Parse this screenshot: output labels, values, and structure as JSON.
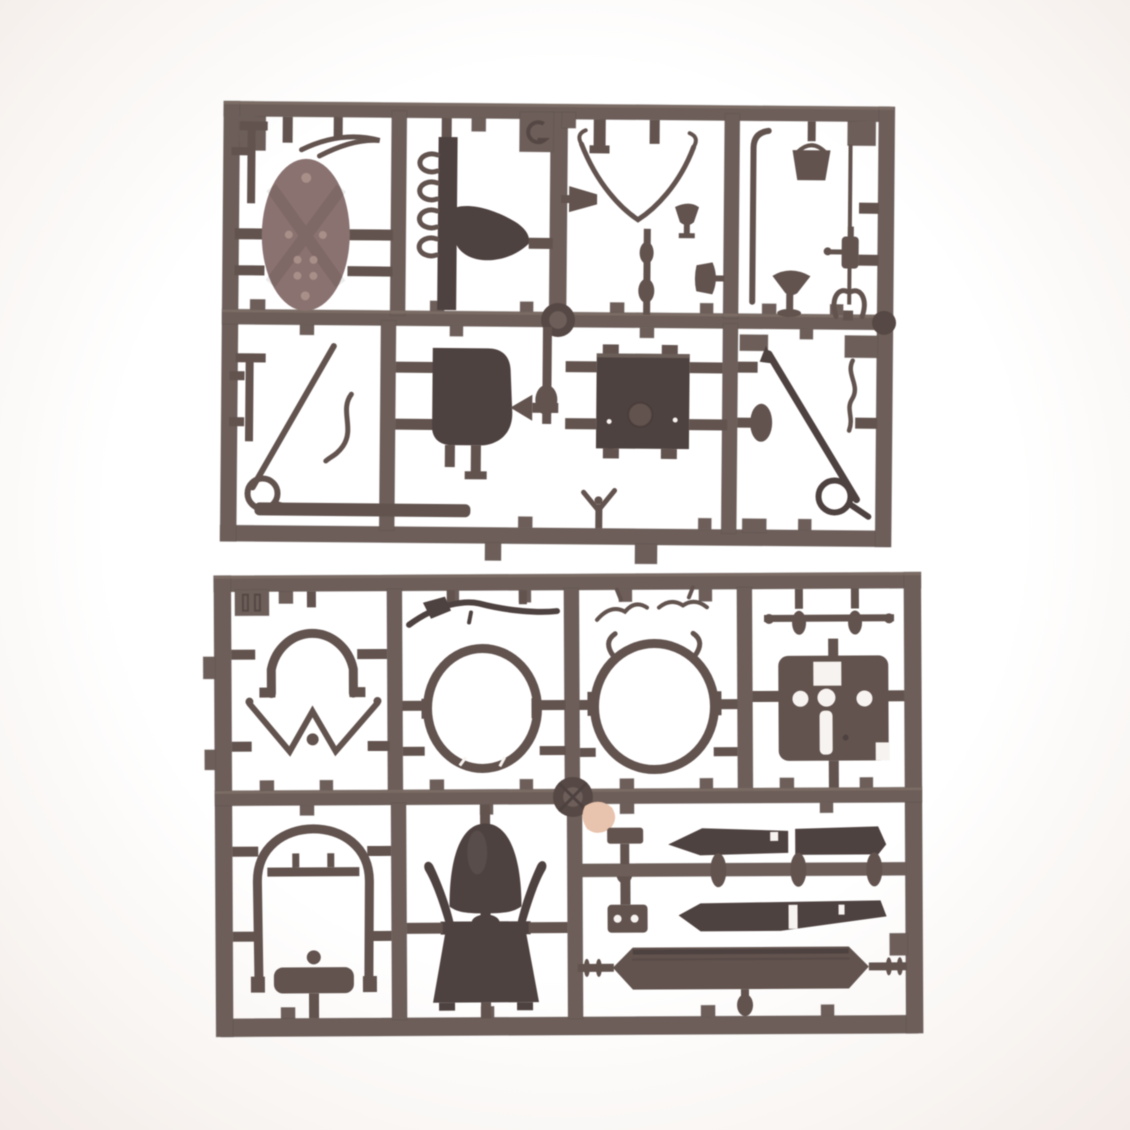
{
  "scene": {
    "type": "photograph",
    "subject": "Two dark grey-brown injection-moulded plastic model-kit sprues (part frames) lying on a plain white background",
    "layout": "upper sprue occupies the top half, lower sprue the bottom half; both are horizontal rectangular frames full of runners and attached parts",
    "sprues": [
      {
        "id": "upper-sprue",
        "structure": "rectangular outer frame, one horizontal mid runner, vertical runners forming 4 upper cells and 3 lower cells, round junction disc at centre",
        "notable_parts": [
          "oval riveted shield plate (lighter red-brown)",
          "curved seat back with four side hooks",
          "wishbone / lyre shaped yoke",
          "trumpet and goblet fittings",
          "turned baluster rod",
          "walking-stick bent rod",
          "small bucket with handle",
          "thin rod with bottle-shaped fitting",
          "bell funnel on stem",
          "pair of curled horns",
          "T-headed rod",
          "long diagonal rod ending in a ring",
          "S-curved hook",
          "flat floor plank",
          "solid bucket seat",
          "strong-box with round knob and two screw dots",
          "plunger with mushroom cap",
          "tiny figure with raised arms",
          "long diagonal spear ending in a ring",
          "wavy bracket strip",
          "embossed moulding tab on the top rail"
        ]
      },
      {
        "id": "lower-sprue",
        "structure": "rectangular outer frame, horizontal mid runner with round junction wheel, vertical runners forming 4 upper cells and 3 lower cells",
        "notable_parts": [
          "embossed moulding tab at top-left",
          "horseshoe arch with flared feet",
          "double-wishbone axle with centre ball",
          "musket-like curved stick",
          "large open oval hoop (left)",
          "large ornate oval hoop with curled horn tips (right)",
          "twiggy antler trim strips",
          "spindle bar with turned beads",
          "rectangular plate with two round holes, centre hole, top cut-out and long slot",
          "tall arched canopy frame with cross bar, knob and rounded base plate",
          "solid dome (helmet) with knob below",
          "flared skirt with two curled horns",
          "small mallet",
          "four long tapered planks / hull blades",
          "small bracket plate with two holes",
          "long hull beam with pointed ends and axle stubs with collar rings",
          "round sprue junction wheel",
          "small pink sticker remnant near the junction wheel"
        ]
      }
    ]
  },
  "colors": {
    "background": "#ffffff",
    "vignette": "#f3ebe7",
    "runner": "#6e5e59",
    "runner_light": "#8a7970",
    "runner_dark": "#574844",
    "part": "#63534e",
    "part_dark": "#4f4240",
    "shield": "#8b7270",
    "shield_dot": "#a98f87",
    "hole": "#f7f3f0",
    "sticker": "#eac3ab",
    "emboss": "#433633"
  }
}
